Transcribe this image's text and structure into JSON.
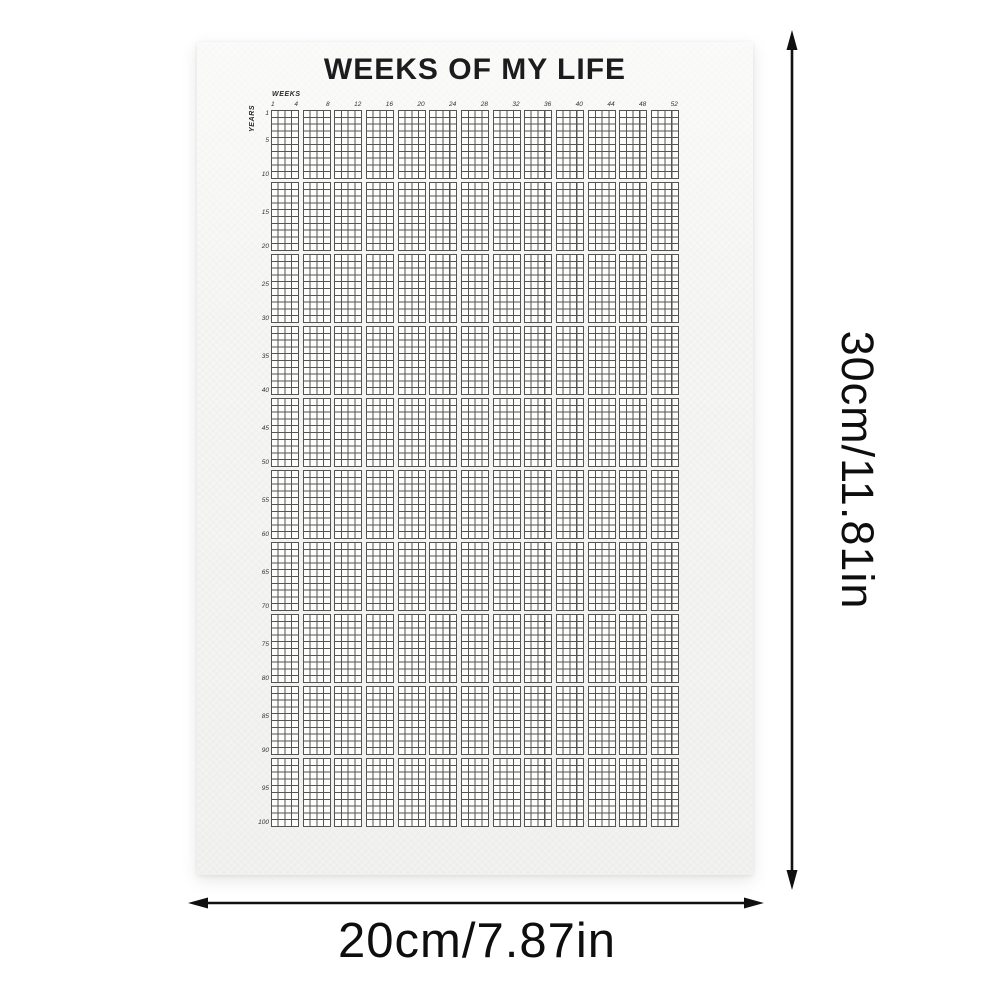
{
  "poster": {
    "title": "WEEKS OF MY LIFE",
    "weeks_axis_label": "WEEKS",
    "years_axis_label": "YEARS",
    "week_tick_labels": [
      "1",
      "4",
      "8",
      "12",
      "16",
      "20",
      "24",
      "28",
      "32",
      "36",
      "40",
      "44",
      "48",
      "52"
    ],
    "year_tick_labels": [
      "1",
      "5",
      "10",
      "15",
      "20",
      "25",
      "30",
      "35",
      "40",
      "45",
      "50",
      "55",
      "60",
      "65",
      "70",
      "75",
      "80",
      "85",
      "90",
      "95",
      "100"
    ],
    "grid": {
      "weeks_per_year": 52,
      "total_years": 100,
      "column_blocks": 13,
      "columns_per_block": 4,
      "row_blocks": 10,
      "rows_per_block": 10,
      "line_color": "#545454",
      "cell_fill": "#fdfdfc",
      "paper_color": "#f6f6f4"
    }
  },
  "dimensions": {
    "height_label": "30cm/11.81in",
    "width_label": "20cm/7.87in",
    "arrow_color": "#101010"
  }
}
